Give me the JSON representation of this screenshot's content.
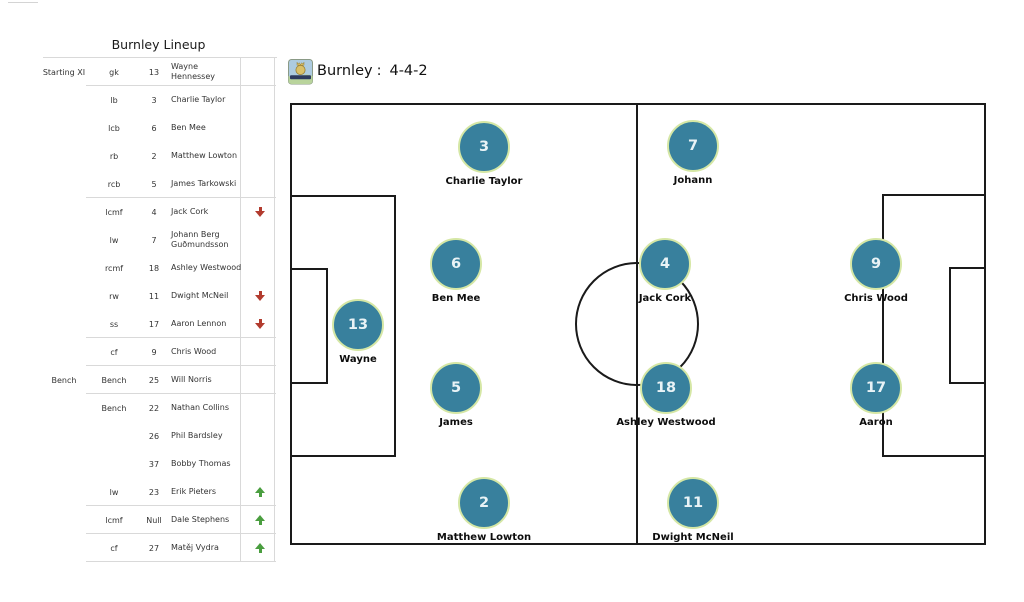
{
  "lineup_table": {
    "title": "Burnley Lineup",
    "rows": [
      {
        "group": "Starting XI",
        "position": "gk",
        "number": "13",
        "name": "Wayne\nHennessey",
        "arrow": null,
        "separator_after": true
      },
      {
        "group": "",
        "position": "lb",
        "number": "3",
        "name": "Charlie Taylor",
        "arrow": null,
        "separator_after": false
      },
      {
        "group": "",
        "position": "lcb",
        "number": "6",
        "name": "Ben Mee",
        "arrow": null,
        "separator_after": false
      },
      {
        "group": "",
        "position": "rb",
        "number": "2",
        "name": "Matthew Lowton",
        "arrow": null,
        "separator_after": false
      },
      {
        "group": "",
        "position": "rcb",
        "number": "5",
        "name": "James Tarkowski",
        "arrow": null,
        "separator_after": true
      },
      {
        "group": "",
        "position": "lcmf",
        "number": "4",
        "name": "Jack Cork",
        "arrow": "down",
        "separator_after": false
      },
      {
        "group": "",
        "position": "lw",
        "number": "7",
        "name": "Johann Berg\nGuðmundsson",
        "arrow": null,
        "separator_after": false
      },
      {
        "group": "",
        "position": "rcmf",
        "number": "18",
        "name": "Ashley Westwood",
        "arrow": null,
        "separator_after": false
      },
      {
        "group": "",
        "position": "rw",
        "number": "11",
        "name": "Dwight McNeil",
        "arrow": "down",
        "separator_after": false
      },
      {
        "group": "",
        "position": "ss",
        "number": "17",
        "name": "Aaron Lennon",
        "arrow": "down",
        "separator_after": true
      },
      {
        "group": "",
        "position": "cf",
        "number": "9",
        "name": "Chris Wood",
        "arrow": null,
        "separator_after": true
      },
      {
        "group": "Bench",
        "position": "Bench",
        "number": "25",
        "name": "Will Norris",
        "arrow": null,
        "separator_after": true
      },
      {
        "group": "",
        "position": "Bench",
        "number": "22",
        "name": "Nathan Collins",
        "arrow": null,
        "separator_after": false
      },
      {
        "group": "",
        "position": "",
        "number": "26",
        "name": "Phil Bardsley",
        "arrow": null,
        "separator_after": false
      },
      {
        "group": "",
        "position": "",
        "number": "37",
        "name": "Bobby Thomas",
        "arrow": null,
        "separator_after": false
      },
      {
        "group": "",
        "position": "lw",
        "number": "23",
        "name": "Erik Pieters",
        "arrow": "up",
        "separator_after": true
      },
      {
        "group": "",
        "position": "lcmf",
        "number": "Null",
        "name": "Dale Stephens",
        "arrow": "up",
        "separator_after": true
      },
      {
        "group": "",
        "position": "cf",
        "number": "27",
        "name": "Matěj Vydra",
        "arrow": "up",
        "separator_after": true
      }
    ]
  },
  "pitch_header": {
    "team": "Burnley",
    "separator": ":",
    "formation": "4-4-2",
    "badge_icon": "burnley-crest-icon"
  },
  "pitch": {
    "formation": "4-4-2",
    "players": [
      {
        "number": "13",
        "label": "Wayne",
        "x": 66,
        "y": 220
      },
      {
        "number": "3",
        "label": "Charlie Taylor",
        "x": 192,
        "y": 42
      },
      {
        "number": "6",
        "label": "Ben Mee",
        "x": 164,
        "y": 159
      },
      {
        "number": "5",
        "label": "James",
        "x": 164,
        "y": 283
      },
      {
        "number": "2",
        "label": "Matthew Lowton",
        "x": 192,
        "y": 398
      },
      {
        "number": "4",
        "label": "Jack Cork",
        "x": 373,
        "y": 159
      },
      {
        "number": "18",
        "label": "Ashley Westwood",
        "x": 374,
        "y": 283
      },
      {
        "number": "7",
        "label": "Johann",
        "x": 401,
        "y": 41
      },
      {
        "number": "11",
        "label": "Dwight McNeil",
        "x": 401,
        "y": 398
      },
      {
        "number": "9",
        "label": "Chris Wood",
        "x": 584,
        "y": 159
      },
      {
        "number": "17",
        "label": "Aaron",
        "x": 584,
        "y": 283
      }
    ]
  },
  "colors": {
    "marker_fill": "#38809d",
    "marker_border": "#d5e7a5",
    "marker_number": "#e9f3f6",
    "pitch_line": "#1a1a1a",
    "arrow_down_red": "#b23b2e",
    "arrow_up_green": "#4a9e3f",
    "table_line": "#d9d9d9"
  }
}
